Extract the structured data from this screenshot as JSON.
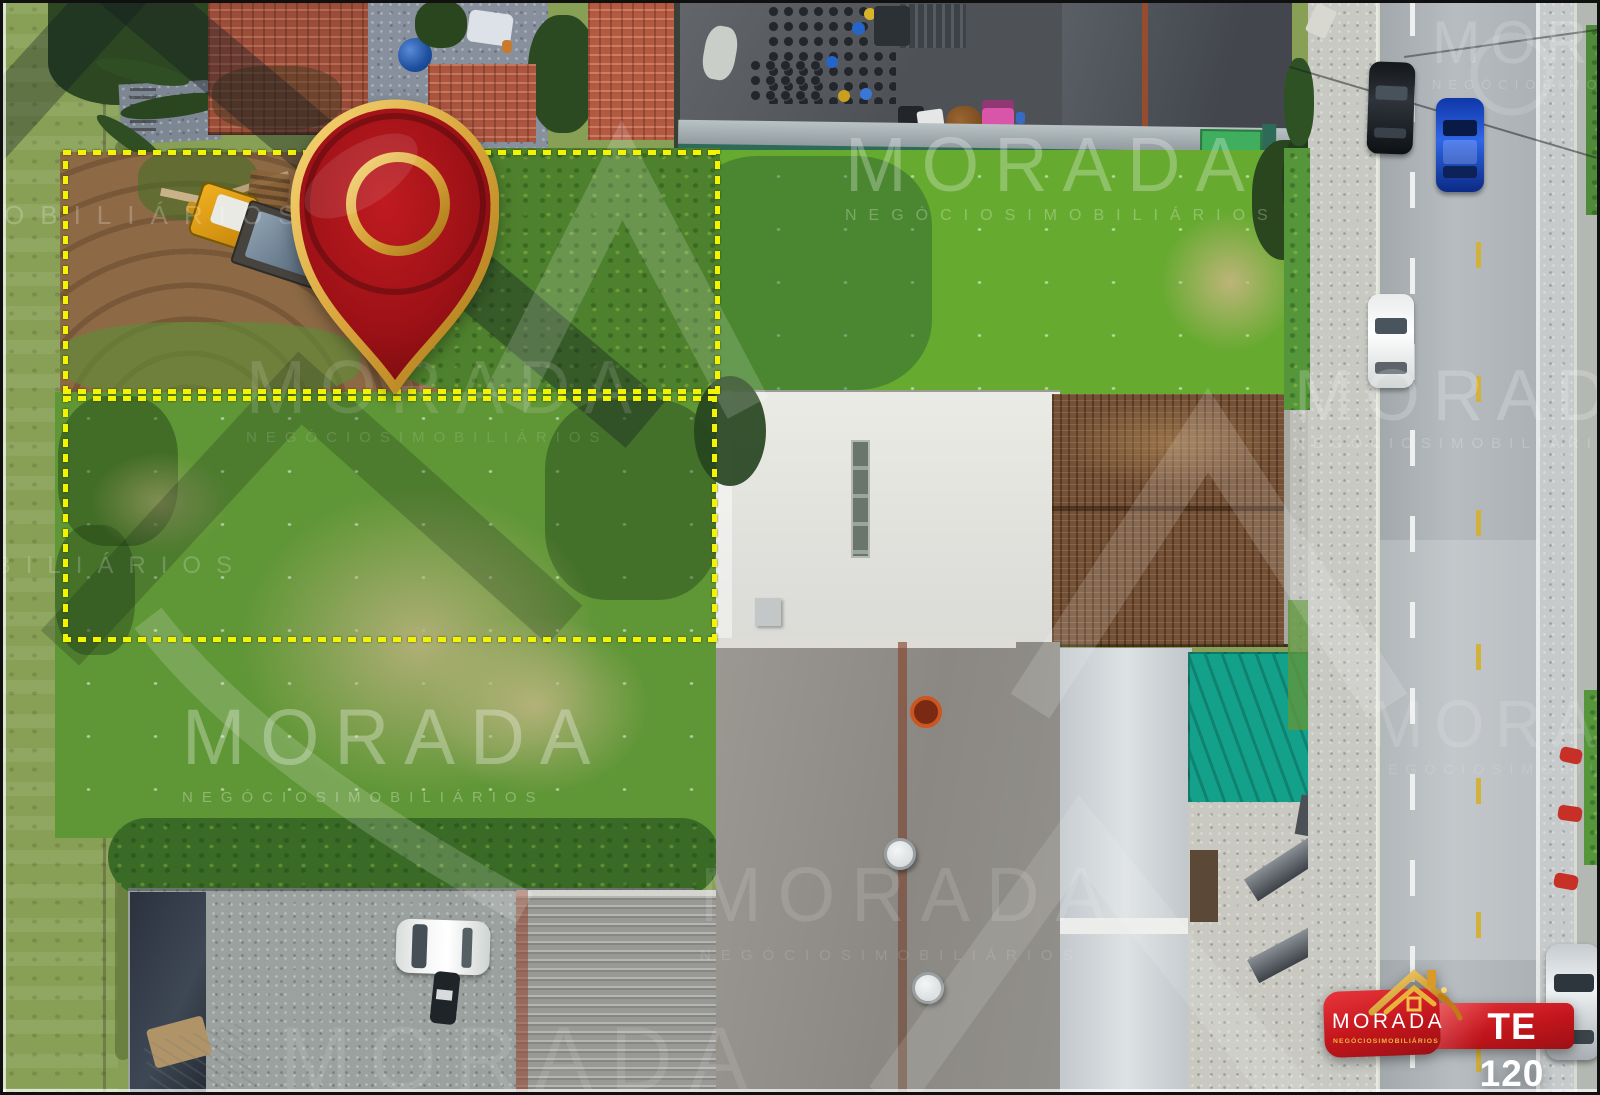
{
  "badge": {
    "code": "TE 120"
  },
  "brand": {
    "name": "MORADA",
    "tagline": "NEGÓCIOSIMOBILIÁRIOS"
  },
  "watermark": {
    "brand": "MORADA",
    "tagline": "NEGÓCIOSIMOBILIÁRIOS"
  },
  "icons": {
    "pin": "map-pin-icon",
    "logo_roof": "house-roof-icon",
    "watermark_mark": "brand-chevron-icon"
  },
  "colors": {
    "boundary_yellow": "#f2f400",
    "badge_red": "#c3151c",
    "pin_red": "#9c1116",
    "pin_gold": "#d9a53c",
    "grass_green": "#66aa30",
    "tarp_teal": "#14a18b",
    "road_asphalt": "#aab0b4"
  }
}
